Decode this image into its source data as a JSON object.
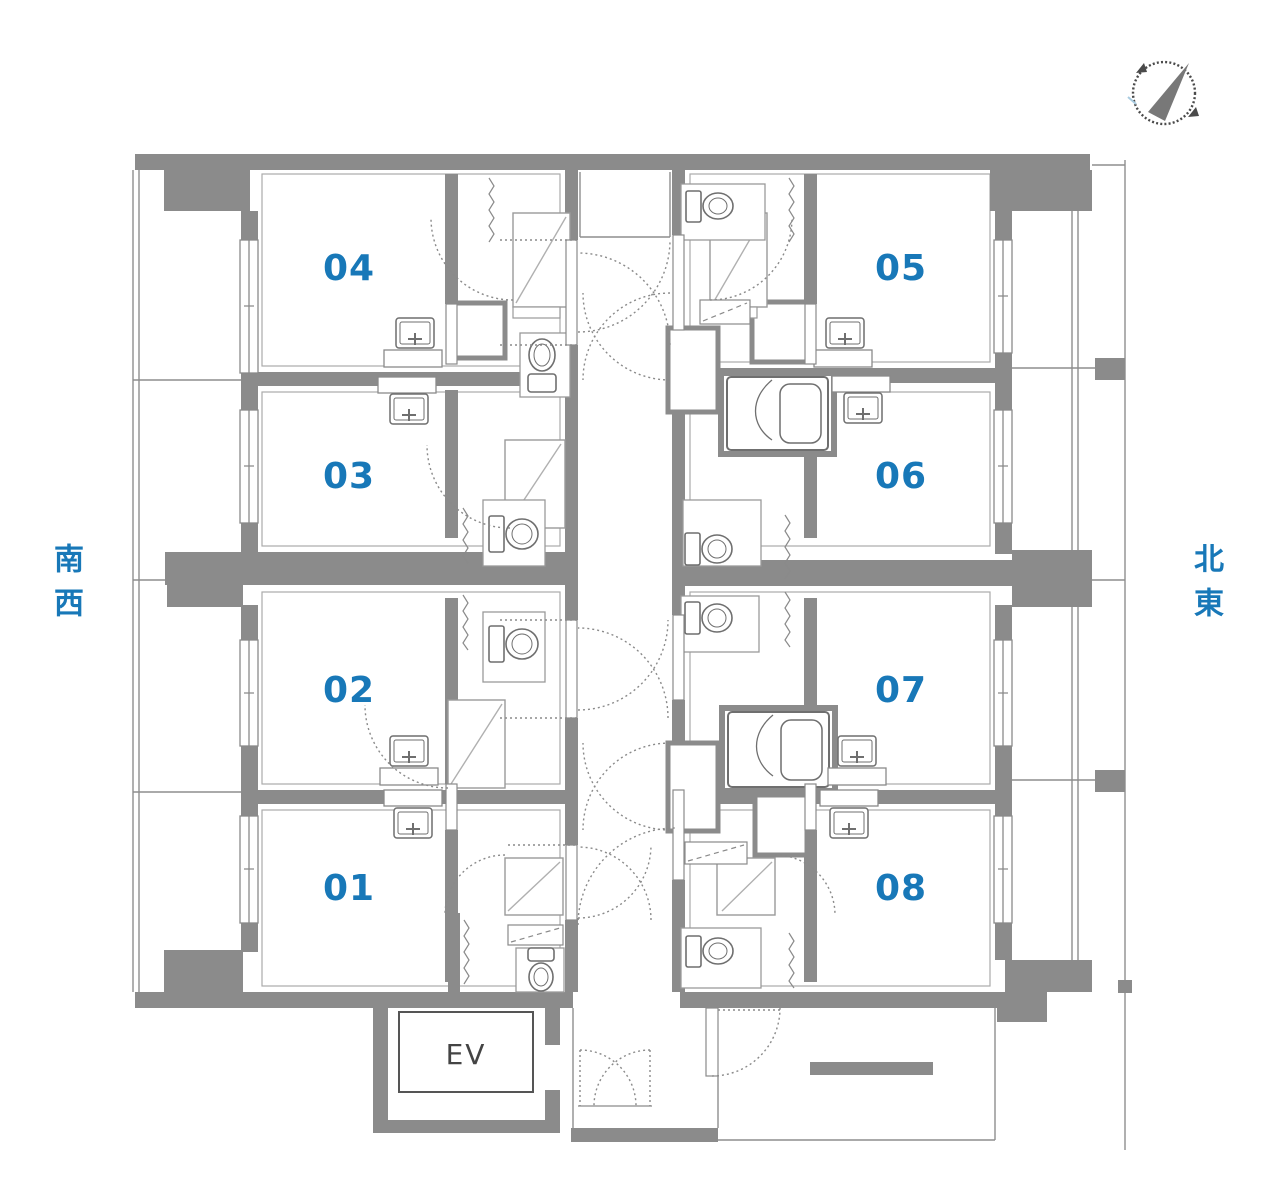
{
  "plan": {
    "units": [
      {
        "label": "01"
      },
      {
        "label": "02"
      },
      {
        "label": "03"
      },
      {
        "label": "04"
      },
      {
        "label": "05"
      },
      {
        "label": "06"
      },
      {
        "label": "07"
      },
      {
        "label": "08"
      }
    ],
    "elevator_label": "EV",
    "direction_labels": {
      "southwest": "南西",
      "northeast": "北東"
    },
    "compass": {
      "icon": "north-arrow-compass"
    },
    "colors": {
      "wall_gray": "#8b8b8b",
      "line_gray": "#8a8a8a",
      "label_blue": "#1878b8",
      "text_dark": "#444444"
    }
  }
}
